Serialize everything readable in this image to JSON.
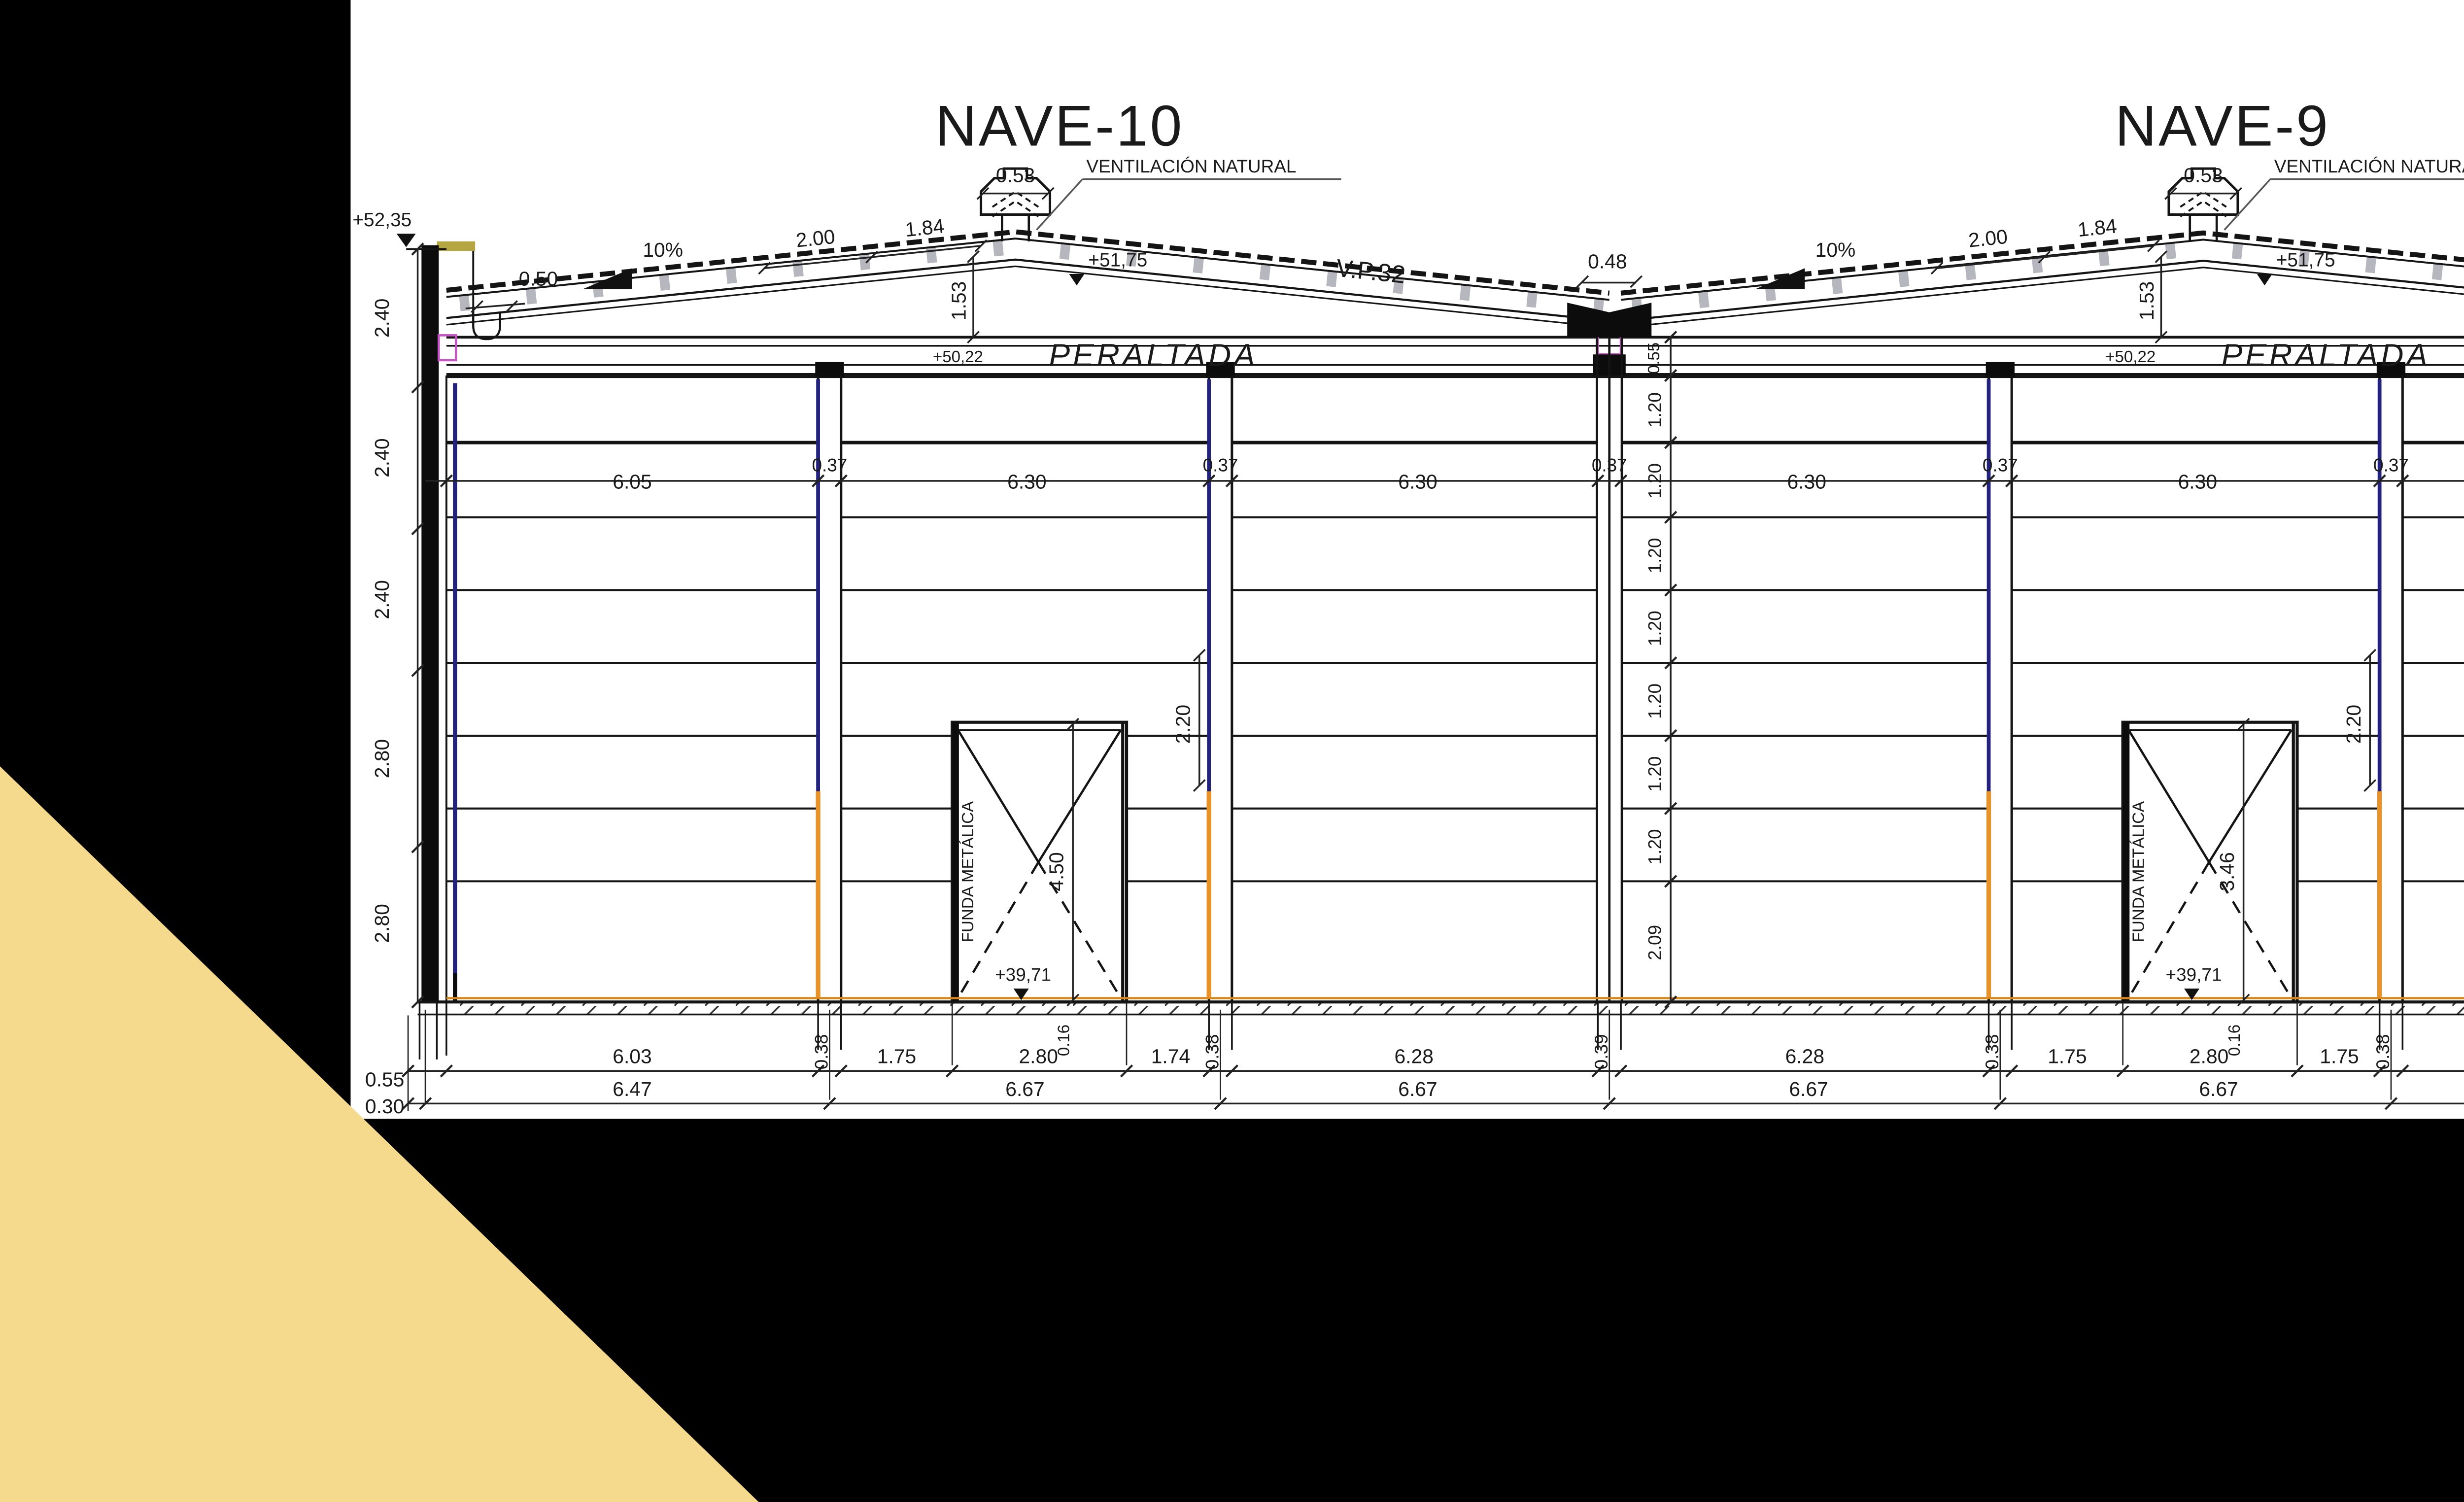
{
  "canvas": {
    "background": "#000000",
    "panel": "#FFFFFF",
    "accent_triangle": "#F5D98C"
  },
  "palette": {
    "navy": "#23237D",
    "orange": "#E8922A",
    "ground_line": "#D8871E",
    "purlin_gray": "#B6B6BE",
    "column_gray": "#9AA3AD",
    "magenta": "#C457C4",
    "ink": "#1A1A1A"
  },
  "titles": {
    "nave_left": "NAVE-10",
    "nave_right": "NAVE-9"
  },
  "levels": {
    "parapet_top": "+52,35",
    "ridge": "+51,75",
    "eave_beam": "+50,22",
    "right_valley": "+50,78",
    "door_floor": "+39,71"
  },
  "roof": {
    "ventilation": "VENTILACIÓN NATURAL",
    "monitor_width": "0.53",
    "slope": "10%",
    "purlin_dim_a": "2.00",
    "purlin_dim_b": "1.84",
    "beam_name": "V.P.32",
    "beam_style": "PERALTADA",
    "ridge_rise": "1.53",
    "gutter_width": "0.50",
    "valley_width": "0.48",
    "right_parapet_width": "0.44"
  },
  "left_chain": [
    "2.40",
    "2.40",
    "2.40",
    "2.80",
    "2.80"
  ],
  "top_row": [
    "6.05",
    "0.37",
    "6.30",
    "0.37",
    "6.30",
    "0.37",
    "6.30",
    "0.37",
    "6.30",
    "0.37",
    "6.30"
  ],
  "center_chain": {
    "top": "0.55",
    "panel": "1.20",
    "bottom": "2.09"
  },
  "right_chain": {
    "panel": "1.20",
    "bottom": "1.51",
    "placas_label": "PLACAS E",
    "first_placa_label": "1ª PLACA"
  },
  "doors": {
    "cover": "FUNDA METÁLICA",
    "left_height": "4.50",
    "right_height": "3.46",
    "lintel": "2.20",
    "slab": "0.16"
  },
  "bottom_row1": [
    "0.55",
    "6.03",
    "0.38",
    "1.75",
    "2.80",
    "1.74",
    "0.38",
    "6.28",
    "0.39",
    "6.28",
    "0.38",
    "1.75",
    "2.80",
    "1.75",
    "0.38",
    "6.28",
    "0.44"
  ],
  "bottom_row2": [
    "0.30",
    "6.47",
    "6.67",
    "6.67",
    "6.67",
    "6.67",
    "6.67"
  ]
}
